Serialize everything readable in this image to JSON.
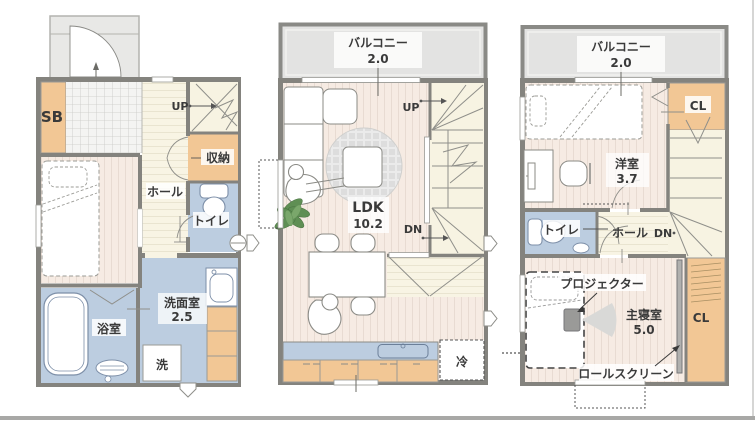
{
  "floorplan": {
    "floors": {
      "f1": {
        "labels": {
          "sb": "SB",
          "up": "UP",
          "storage": "収納",
          "hall": "ホール",
          "toilet": "トイレ",
          "bath": "浴室",
          "washroom": "洗面室",
          "washroom_size": "2.5",
          "washer": "洗"
        }
      },
      "f2": {
        "labels": {
          "balcony": "バルコニー",
          "balcony_size": "2.0",
          "up": "UP",
          "ldk": "LDK",
          "ldk_size": "10.2",
          "dn": "DN",
          "fridge": "冷"
        }
      },
      "f3": {
        "labels": {
          "balcony": "バルコニー",
          "balcony_size": "2.0",
          "closet_top": "CL",
          "western_room": "洋室",
          "western_room_size": "3.7",
          "toilet": "トイレ",
          "hall": "ホール",
          "dn": "DN",
          "projector": "プロジェクター",
          "master_bedroom": "主寝室",
          "master_bedroom_size": "5.0",
          "roll_screen": "ロールスクリーン",
          "closet_bottom": "CL"
        }
      }
    },
    "colors": {
      "wall": "#84837e",
      "closet_orange": "#f2c795",
      "wet_area_blue": "#bccde0",
      "hall_cream": "#f8f4e4",
      "room_pink": "#f6ebe3",
      "balcony_gray": "#e3e3e2",
      "stair_cream": "#f7f3e2",
      "fixture_line": "#8d8d88",
      "text": "#3a3a3a"
    }
  }
}
